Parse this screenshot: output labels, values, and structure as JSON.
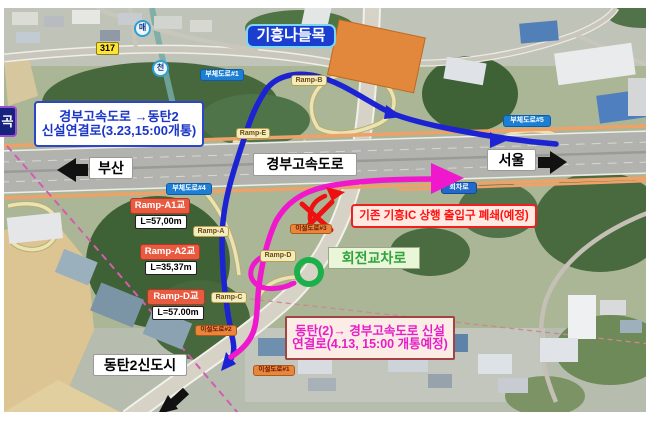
{
  "badges": {
    "interchange_title": "기흥나들목",
    "route_shield": "317",
    "stream_marker_1": "매",
    "stream_marker_2": "천",
    "left_edge_cut": "곡"
  },
  "direction": {
    "busan": "부산",
    "seoul": "서울",
    "highway_name": "경부고속도로",
    "dongtan_city": "동탄2신도시"
  },
  "info_boxes": {
    "new_connector_line1": "경부고속도로 →동탄2",
    "new_connector_line2": "신설연결로(3.23,15:00개통)",
    "closure_notice": "기존 기흥IC 상행 출입구 폐쇄(예정)",
    "dongtan_connector_line1": "동탄(2)→ 경부고속도로 신설",
    "dongtan_connector_line2": "연결로(4.13, 15:00 개통예정)",
    "roundabout": "회전교차로",
    "turnaround": "회차로"
  },
  "ramp_bridges": [
    {
      "name": "Ramp-A1교",
      "length": "L=57,00m"
    },
    {
      "name": "Ramp-A2교",
      "length": "L=35,37m"
    },
    {
      "name": "Ramp-D교",
      "length": "L=57.00m"
    }
  ],
  "ramp_tags": {
    "a": "Ramp-A",
    "b": "Ramp-B",
    "c": "Ramp-C",
    "d": "Ramp-D",
    "e": "Ramp-E"
  },
  "side_roads": {
    "no1": "부체도로#1",
    "no4": "부체도로#4",
    "no5": "부체도로#5"
  },
  "relocated_roads": {
    "no1": "이설도로#1",
    "no2": "이설도로#2",
    "no3": "이설도로#3"
  },
  "colors": {
    "route_to_dongtan_blue": "#1c23d2",
    "route_to_highway_magenta": "#ef18cd",
    "closure_red": "#ee1111",
    "roundabout_green": "#1db04a"
  }
}
